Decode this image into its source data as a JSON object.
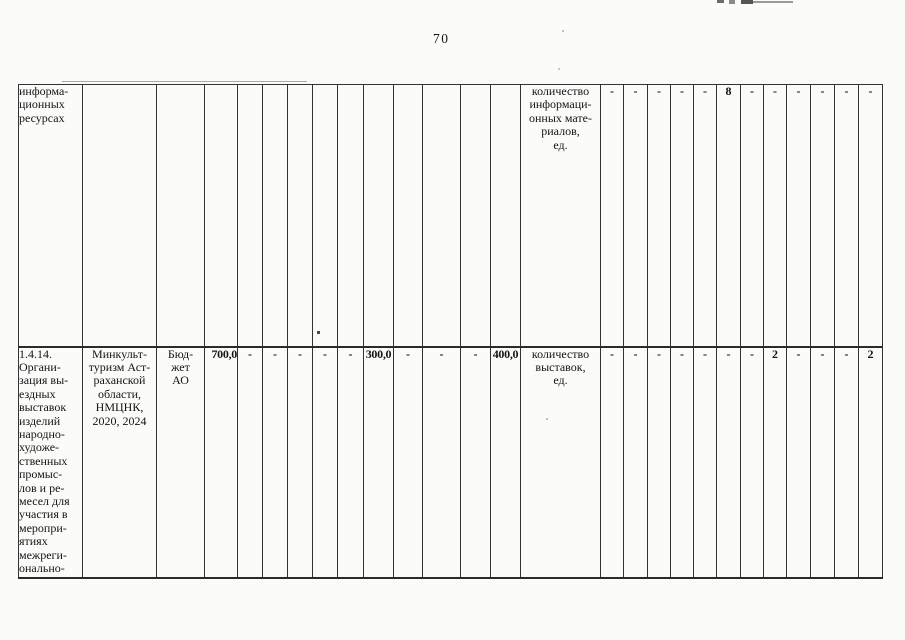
{
  "page": {
    "number": "70"
  },
  "table": {
    "rows": [
      {
        "cells": [
          "информа-\nционных\nресурсах",
          "",
          "",
          "",
          "",
          "",
          "",
          "",
          "",
          "",
          "",
          "",
          "",
          "",
          "количество\nинформаци-\nонных мате-\nриалов,\nед.",
          "-",
          "-",
          "-",
          "-",
          "-",
          "8",
          "-",
          "-",
          "-",
          "-",
          "-",
          "-"
        ]
      },
      {
        "cells": [
          "1.4.14.\nОргани-\nзация вы-\nездных\nвыставок\nизделий\nнародно-\nхудоже-\nственных\nпромыс-\nлов и ре-\nмесел для\nучастия в\nмеропри-\nятиях\nмежреги-\nонально-",
          "Минкульт-\nтуризм Аст-\nраханской\nобласти,\nНМЦНК,\n2020, 2024",
          "Бюд-\nжет\nАО",
          "700,0",
          "-",
          "-",
          "-",
          "-",
          "-",
          "300,0",
          "-",
          "-",
          "-",
          "400,0",
          "количество\nвыставок,\nед.",
          "-",
          "-",
          "-",
          "-",
          "-",
          "-",
          "-",
          "2",
          "-",
          "-",
          "-",
          "2"
        ]
      }
    ]
  }
}
